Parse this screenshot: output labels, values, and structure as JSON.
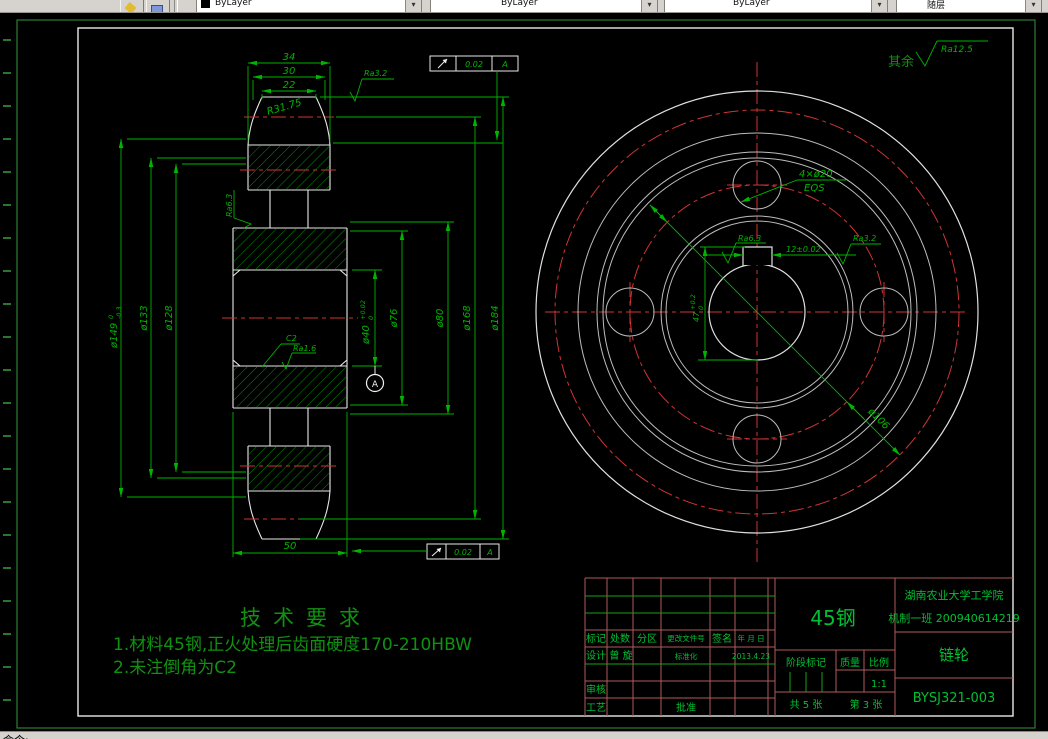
{
  "toolbar": {
    "combos": [
      {
        "label": "ByLayer"
      },
      {
        "label": "ByLayer"
      },
      {
        "label": "ByLayer"
      },
      {
        "label": "随层"
      }
    ],
    "dropdown_glyph": "▾"
  },
  "command_line": {
    "text": "命令:"
  },
  "colors": {
    "background": "#000000",
    "outline_white": "#e9e9e9",
    "dimension_green": "#00b400",
    "hatch_green": "#00a000",
    "centerline_red": "#d03434",
    "titleblock_grid_red": "#b05a5a",
    "titleblock_text_green": "#00c033",
    "paper_border_green": "#2f7d32",
    "toolbar_gray": "#d6d3ce"
  },
  "left_view": {
    "dim_34": "34",
    "dim_30": "30",
    "dim_22": "22",
    "radius_label": "R31.75",
    "ra_3_2": "Ra3.2",
    "tol_frame_top": {
      "value": "0.02",
      "datum": "A"
    },
    "tol_frame_bottom": {
      "value": "0.02",
      "datum": "A"
    },
    "dia_149": "ø149",
    "dia_149_tol_up": "0",
    "dia_149_tol_dn": "-0.3",
    "dia_133": "ø133",
    "dia_128": "ø128",
    "ra_6_3": "Ra6.3",
    "chamfer": "C2",
    "ra_1_6": "Ra1.6",
    "dia_40": "ø40",
    "dia_40_tol_up": "+0.02",
    "dia_40_tol_dn": "0",
    "dia_76": "ø76",
    "dia_80": "ø80",
    "dia_168": "ø168",
    "dia_184": "ø184",
    "dim_50": "50",
    "datum_label": "A"
  },
  "right_view": {
    "surface_note": "其余",
    "surface_note_ra": "Ra12.5",
    "holes_label": "4×ø20",
    "holes_eqs": "EQS",
    "ra_6_3": "Ra6.3",
    "ra_3_2": "Ra3.2",
    "keyway_width": "12±0.02",
    "keyway_depth": "47",
    "keyway_depth_tol_up": "+0.2",
    "keyway_depth_tol_dn": "0",
    "bolt_circle": "ø106"
  },
  "tech_req": {
    "title": "技术要求",
    "line1": "1.材料45钢,正火处理后齿面硬度170-210HBW",
    "line2": "2.未注倒角为C2"
  },
  "title_block": {
    "material": "45钢",
    "school": "湖南农业大学工学院",
    "class_id": "机制一班 200940614219",
    "part_name": "链轮",
    "drawing_no": "BYSJ321-003",
    "col_biaoji": "标记",
    "col_chushu": "处数",
    "col_fenqu": "分区",
    "col_change_file": "更改文件号",
    "col_signature": "签名",
    "col_date": "年 月 日",
    "design_label": "设计",
    "designer": "曾 旋",
    "standard_label": "标准化",
    "design_date": "2013.4.23",
    "review_label": "审核",
    "process_label": "工艺",
    "approve_label": "批准",
    "stage_label": "阶段标记",
    "weight_label": "质量",
    "scale_label": "比例",
    "scale_value": "1:1",
    "sheets_total": "共 5 张",
    "sheet_no": "第 3 张"
  }
}
